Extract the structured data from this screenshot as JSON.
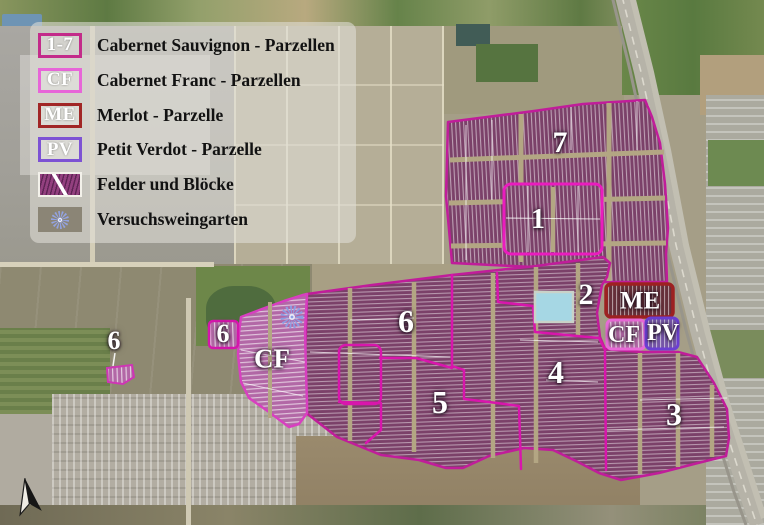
{
  "legend": {
    "items": [
      {
        "code": "1-7",
        "label": "Cabernet Sauvignon - Parzellen"
      },
      {
        "code": "CF",
        "label": "Cabernet Franc - Parzellen"
      },
      {
        "code": "ME",
        "label": "Merlot - Parzelle"
      },
      {
        "code": "PV",
        "label": "Petit Verdot - Parzelle"
      },
      {
        "code": "",
        "label": "Felder und Blöcke"
      },
      {
        "code": "",
        "label": "Versuchsweingarten"
      }
    ]
  },
  "map": {
    "parcel_labels": [
      {
        "id": "parcel-7",
        "text": "7"
      },
      {
        "id": "parcel-1",
        "text": "1"
      },
      {
        "id": "parcel-2",
        "text": "2"
      },
      {
        "id": "parcel-3",
        "text": "3"
      },
      {
        "id": "parcel-4",
        "text": "4"
      },
      {
        "id": "parcel-5",
        "text": "5"
      },
      {
        "id": "parcel-6",
        "text": "6"
      },
      {
        "id": "parcel-6-small",
        "text": "6"
      },
      {
        "id": "parcel-6-west",
        "text": "6"
      },
      {
        "id": "cf-left",
        "text": "CF"
      },
      {
        "id": "merlot",
        "text": "ME"
      },
      {
        "id": "cf-east",
        "text": "CF"
      },
      {
        "id": "petit-verdot",
        "text": "PV"
      }
    ]
  },
  "colors": {
    "cs_outline": "#c2219a",
    "cs_bright_outline": "#e81cbe",
    "cf_outline": "#e96ad8",
    "me_outline": "#9d2121",
    "pv_outline": "#6b3fd2",
    "field_fill": "#7b4169",
    "cf_fill": "#b268a6",
    "me_fill": "#66303a",
    "pv_fill": "#7656a8",
    "pond": "#a6d7e4",
    "starburst": "#8d9de2"
  }
}
